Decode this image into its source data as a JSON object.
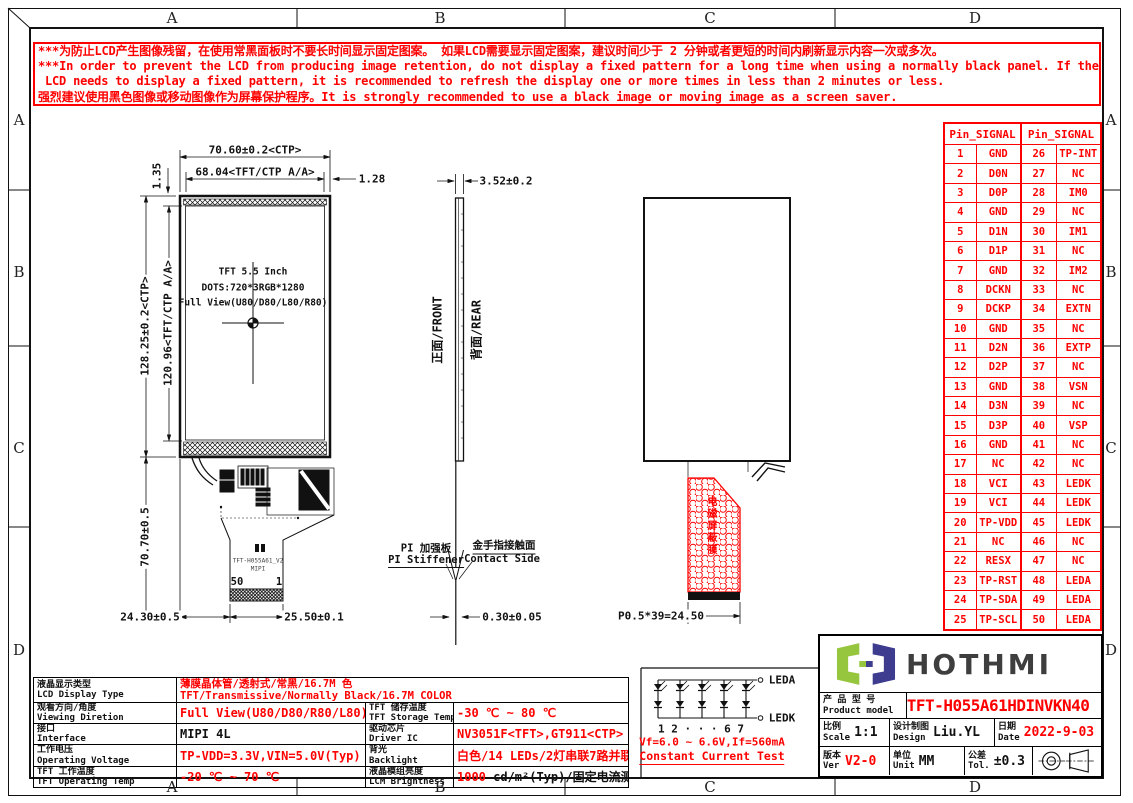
{
  "colors": {
    "red": "#ff0000",
    "black": "#111111",
    "logo_green": "#96c63d",
    "logo_navy": "#3d3c8e",
    "brand_gray": "#3e3e3e"
  },
  "grid": {
    "letters": [
      "A",
      "B",
      "C",
      "D"
    ]
  },
  "warning": {
    "lines": [
      "***为防止LCD产生图像残留，在使用常黑面板时不要长时间显示固定图案。 如果LCD需要显示固定图案，建议时间少于 2 分钟或者更短的时间内刷新显示内容一次或多次。",
      "***In order to prevent the LCD from producing image retention, do not display a fixed pattern for a long time when using a normally black panel. If the",
      "LCD needs to display a fixed pattern, it is recommended to refresh the display one or more times in less than 2 minutes or less.",
      "强烈建议使用黑色图像或移动图像作为屏幕保护程序。It is strongly recommended to use a black image or moving image as a screen saver."
    ]
  },
  "pin_table": {
    "header": "Pin_SIGNAL",
    "rows": [
      [
        1,
        "GND",
        26,
        "TP-INT"
      ],
      [
        2,
        "D0N",
        27,
        "NC"
      ],
      [
        3,
        "D0P",
        28,
        "IM0"
      ],
      [
        4,
        "GND",
        29,
        "NC"
      ],
      [
        5,
        "D1N",
        30,
        "IM1"
      ],
      [
        6,
        "D1P",
        31,
        "NC"
      ],
      [
        7,
        "GND",
        32,
        "IM2"
      ],
      [
        8,
        "DCKN",
        33,
        "NC"
      ],
      [
        9,
        "DCKP",
        34,
        "EXTN"
      ],
      [
        10,
        "GND",
        35,
        "NC"
      ],
      [
        11,
        "D2N",
        36,
        "EXTP"
      ],
      [
        12,
        "D2P",
        37,
        "NC"
      ],
      [
        13,
        "GND",
        38,
        "VSN"
      ],
      [
        14,
        "D3N",
        39,
        "NC"
      ],
      [
        15,
        "D3P",
        40,
        "VSP"
      ],
      [
        16,
        "GND",
        41,
        "NC"
      ],
      [
        17,
        "NC",
        42,
        "NC"
      ],
      [
        18,
        "VCI",
        43,
        "LEDK"
      ],
      [
        19,
        "VCI",
        44,
        "LEDK"
      ],
      [
        20,
        "TP-VDD",
        45,
        "LEDK"
      ],
      [
        21,
        "NC",
        46,
        "NC"
      ],
      [
        22,
        "RESX",
        47,
        "NC"
      ],
      [
        23,
        "TP-RST",
        48,
        "LEDA"
      ],
      [
        24,
        "TP-SDA",
        49,
        "LEDA"
      ],
      [
        25,
        "TP-SCL",
        50,
        "LEDA"
      ]
    ]
  },
  "front_view": {
    "line1": "TFT 5.5 Inch",
    "line2": "DOTS:720*3RGB*1280",
    "line3": "Full View(U80/D80/L80/R80)",
    "pin_start": "50",
    "pin_end": "1",
    "fpc_text1": "TFT-H055A61_V2",
    "fpc_text2": "MIPI"
  },
  "dims": {
    "width_ctp": "70.60±0.2<CTP>",
    "width_aa": "68.04<TFT/CTP A/A>",
    "right_bezel": "1.28",
    "top_bezel": "1.35",
    "height_ctp": "128.25±0.2<CTP>",
    "height_aa": "120.96<TFT/CTP A/A>",
    "tail_height": "70.70±0.5",
    "tail_left": "24.30±0.5",
    "tail_right": "25.50±0.1",
    "thickness": "3.52±0.2",
    "fpc_thickness": "0.30±0.05",
    "pitch": "P0.5*39=24.50"
  },
  "side_view": {
    "front": "正面/FRONT",
    "rear": "背面/REAR",
    "stiffener_zh": "PI 加强板",
    "stiffener_en": "PI Stiffener",
    "contact_zh": "金手指接触面",
    "contact_en": "Contact Side"
  },
  "rear_view": {
    "shield": "电磁屏蔽膜"
  },
  "backlight_circuit": {
    "leda": "LEDA",
    "ledk": "LEDK",
    "index_row": "1  2 · · ·  6  7",
    "vf": "Vf=6.0 ~ 6.6V,If=560mA",
    "test": "Constant Current Test"
  },
  "spec": {
    "r0": {
      "zh": "液晶显示类型",
      "en": "LCD Display Type",
      "v1": "薄膜晶体管/透射式/常黑/16.7M 色",
      "v2": "TFT/Transmissive/Normally Black/16.7M COLOR"
    },
    "r1l": {
      "zh": "观看方向/角度",
      "en": "Viewing Diretion",
      "v": "Full View(U80/D80/R80/L80)"
    },
    "r1r": {
      "zh": "TFT 储存温度",
      "en": "TFT Storage Temp",
      "v": "-30 ℃ ~ 80 ℃"
    },
    "r2l": {
      "zh": "接口",
      "en": "Interface",
      "v": "MIPI 4L"
    },
    "r2r": {
      "zh": "驱动芯片",
      "en": "Driver IC",
      "v": "NV3051F<TFT>,GT911<CTP>"
    },
    "r3l": {
      "zh": "工作电压",
      "en": "Operating Voltage",
      "v": "TP-VDD=3.3V,VIN=5.0V(Typ)"
    },
    "r3r": {
      "zh": "背光",
      "en": "Backlight",
      "v": "白色/14 LEDs/2灯串联7路并联"
    },
    "r4l": {
      "zh": "TFT 工作温度",
      "en": "TFT Operating Temp",
      "v": "-20 ℃ ~ 70 ℃"
    },
    "r4r": {
      "zh": "液晶模组亮度",
      "en": "LCM Brightness",
      "v_red": "1000",
      "v_rest": " cd/m²(Typ)/固定电流测试"
    }
  },
  "title_block": {
    "brand": "HOTHMI",
    "product_zh": "产 品 型 号",
    "product_en": "Product model",
    "model": "TFT-H055A61HDINVKN40",
    "scale_zh": "比例",
    "scale_en": "Scale",
    "scale": "1:1",
    "design_zh": "设计制图",
    "design_en": "Design",
    "design": "Liu.YL",
    "date_zh": "日期",
    "date_en": "Date",
    "date": "2022-9-03",
    "ver_zh": "版本",
    "ver_en": "Ver",
    "ver": "V2-0",
    "unit_zh": "单位",
    "unit_en": "Unit",
    "unit": "MM",
    "tol_zh": "公差",
    "tol_en": "Tol.",
    "tol": "±0.3"
  }
}
